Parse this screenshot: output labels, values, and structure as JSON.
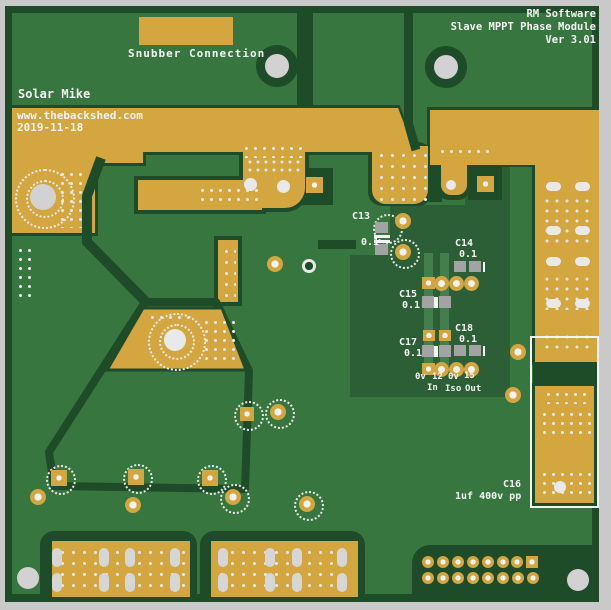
{
  "title_block": {
    "company": "RM Software",
    "module": "Slave MPPT Phase Module",
    "version": "Ver 3.01"
  },
  "silkscreen": {
    "snubber_label": "Snubber Connection",
    "author": "Solar Mike",
    "website": "www.thebackshed.com",
    "date": "2019-11-18"
  },
  "capacitors": [
    {
      "ref": "C13",
      "value": "0.1"
    },
    {
      "ref": "C14",
      "value": "0.1"
    },
    {
      "ref": "C15",
      "value": "0.1"
    },
    {
      "ref": "C17",
      "value": "0.1"
    },
    {
      "ref": "C18",
      "value": "0.1"
    },
    {
      "ref": "C16",
      "value": "1uf 400v pp"
    }
  ],
  "pin_labels": {
    "p1": "0v",
    "p2": "12",
    "p3": "0v",
    "p4": "15",
    "r1": "In",
    "r2": "Iso",
    "r3": "Out"
  },
  "colors": {
    "board_green": "#387640",
    "clearance_dark_green": "#1e4b28",
    "inner_zone_green": "#2d5f36",
    "copper_gold": "#d3a63f",
    "hole_gray": "#d2d2d2",
    "silkscreen_white": "#f4f4f4",
    "margin_gray": "#c9c9c9"
  }
}
